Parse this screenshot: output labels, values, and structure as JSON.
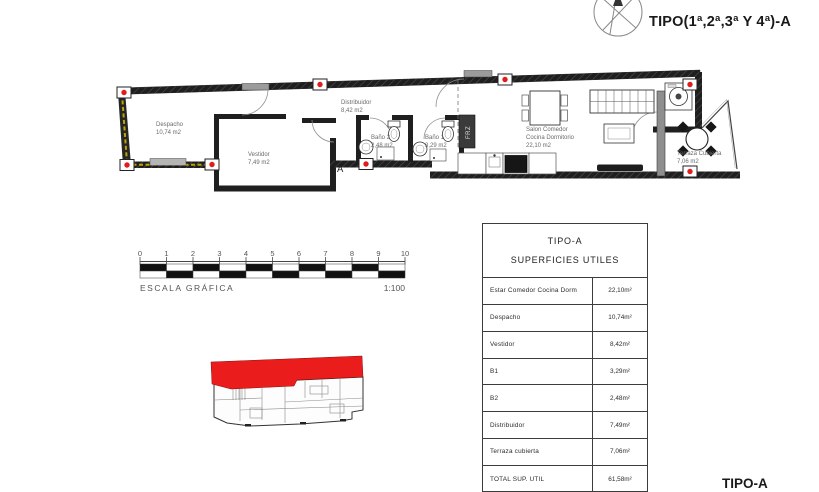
{
  "title": "TIPO(1ª,2ª,3ª Y 4ª)-A",
  "footer_label": "TIPO-A",
  "plan": {
    "rooms": [
      {
        "name": "Despacho",
        "area": "10,74 m2"
      },
      {
        "name": "Vestidor",
        "area": "7,49 m2"
      },
      {
        "name": "Distribuidor",
        "area": "8,42 m2"
      },
      {
        "name": "Baño 2",
        "area": "2,48 m2"
      },
      {
        "name": "Baño 1",
        "area": "3,29 m2"
      },
      {
        "name": "Salon Comedor",
        "name2": "Cocina Dormitorio",
        "area": "22,10 m2"
      },
      {
        "name": "Terraza Cubierta",
        "area": "7,06 m2"
      }
    ],
    "section_marker": "A",
    "appliance_label": "FRZ"
  },
  "scalebar": {
    "ticks": [
      "0",
      "1",
      "2",
      "3",
      "4",
      "5",
      "6",
      "7",
      "8",
      "9",
      "10"
    ],
    "label": "ESCALA GRÁFICA",
    "ratio": "1:100"
  },
  "table": {
    "title_line1": "TIPO-A",
    "title_line2": "SUPERFICIES UTILES",
    "rows": [
      {
        "label": "Estar Comedor Cocina Dorm",
        "value": "22,10m²"
      },
      {
        "label": "Despacho",
        "value": "10,74m²"
      },
      {
        "label": "Vestidor",
        "value": "8,42m²"
      },
      {
        "label": "B1",
        "value": "3,29m²"
      },
      {
        "label": "B2",
        "value": "2,48m²"
      },
      {
        "label": "Distribuidor",
        "value": "7,49m²"
      },
      {
        "label": "Terraza cubierta",
        "value": "7,06m²"
      },
      {
        "label": "TOTAL SUP. UTIL",
        "value": "61,58m²"
      }
    ]
  },
  "colors": {
    "accent_red": "#e11c1c",
    "wall_black": "#1f1f1f",
    "hatch_yellow": "#bfa300",
    "divider_gray": "#8e8e8e"
  }
}
